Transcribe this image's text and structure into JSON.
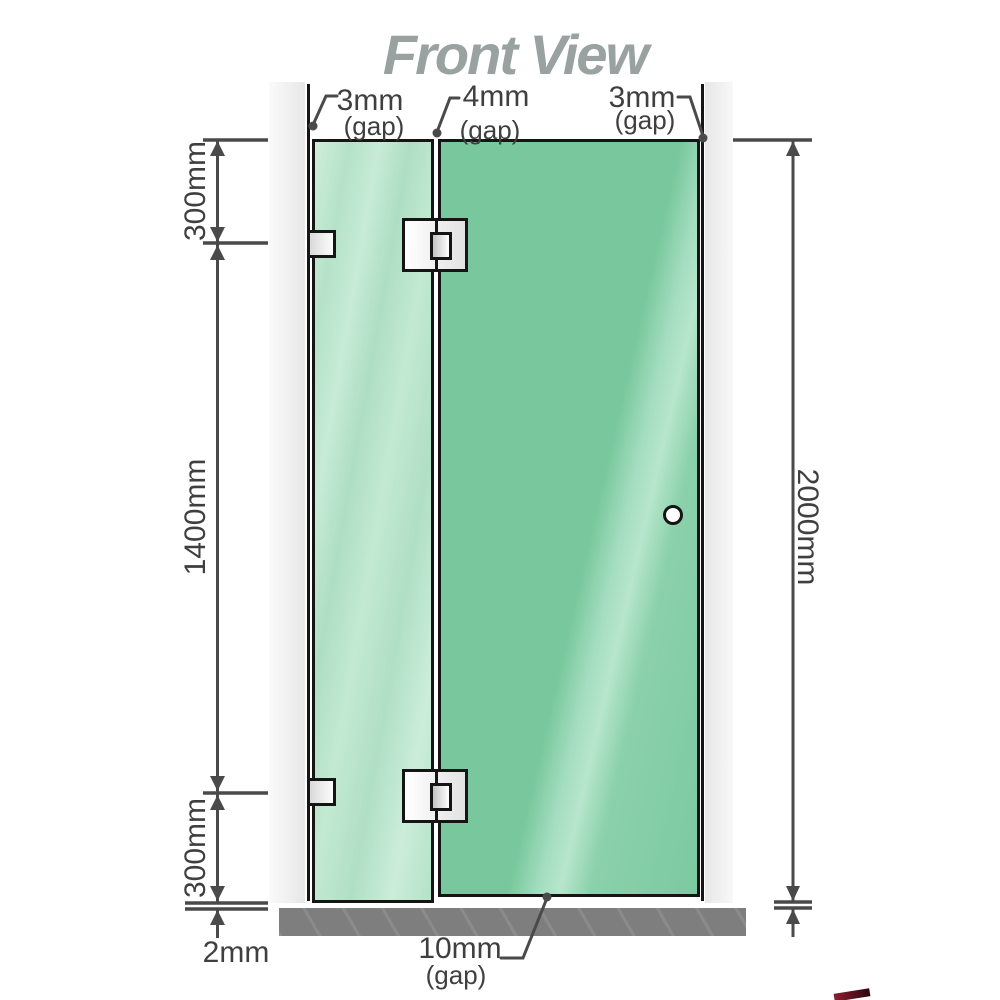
{
  "title": "Front View",
  "annotations": {
    "top_left_gap": {
      "value": "3mm",
      "note": "(gap)"
    },
    "top_middle_gap": {
      "value": "4mm",
      "note": "(gap)"
    },
    "top_right_gap": {
      "value": "3mm",
      "note": "(gap)"
    },
    "bottom_gap": {
      "value": "10mm",
      "note": "(gap)"
    },
    "left_top": "300mm",
    "left_middle": "1400mm",
    "left_bottom": "300mm",
    "floor_clearance": "2mm",
    "right_height": "2000mm"
  },
  "colors": {
    "door_green": "#79c89d",
    "door_green_light": "#b7e6cc",
    "panel_green": "#b5e2c8",
    "panel_green_light": "#cfeeda",
    "wall_gray": "#e7e7e7",
    "floor_gray": "#7e7e7e",
    "line_dark": "#151515",
    "dim_gray": "#4a4a4a",
    "text_gray": "#3f3f3f",
    "title_gray": "#9aa1a1",
    "logo_red": "#8c1d31"
  }
}
